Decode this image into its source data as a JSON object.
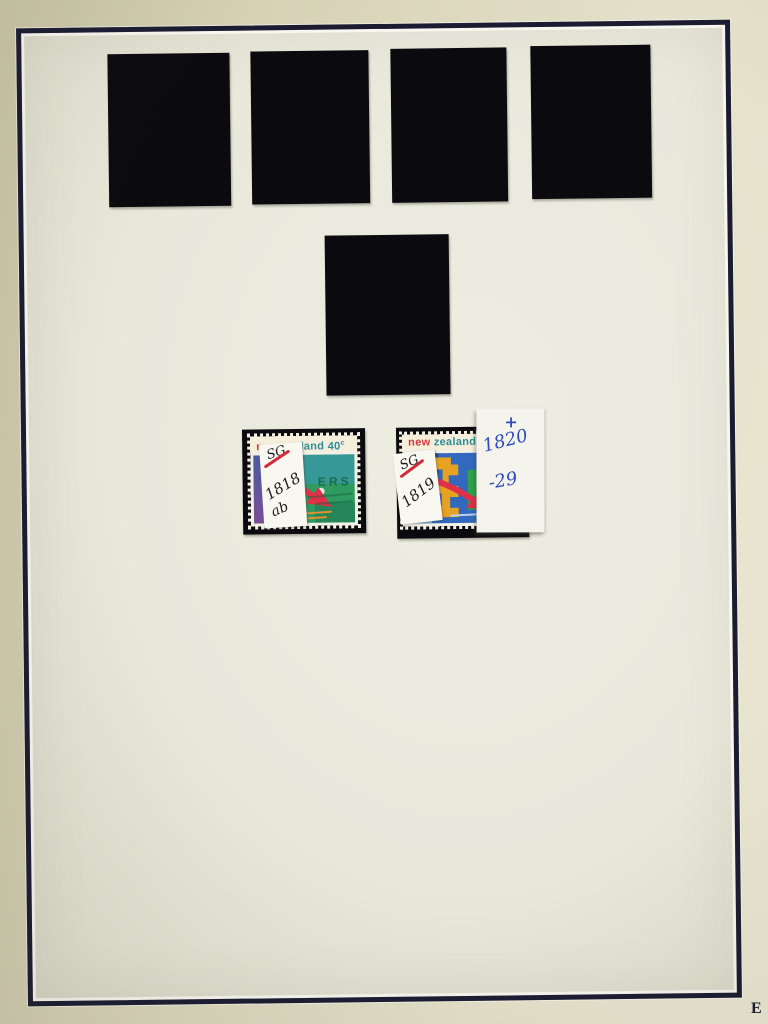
{
  "photo": {
    "corner_mark": "E"
  },
  "colors": {
    "frame_navy": "#1b1b32",
    "paper": "#e9e8db",
    "outer_album": "#d7d2b6",
    "mount_black": "#0b0b0f",
    "stamp_red": "#d4383f",
    "stamp_teal": "#2d8e99",
    "cancel_green": "#12603a",
    "ink_black": "#1d1d1d",
    "ink_blue": "#2f4cc0",
    "slash_red": "#d5293c"
  },
  "mounts": {
    "top_row_count": 4,
    "middle_count": 1
  },
  "stamp_left": {
    "country_word1": "new",
    "country_word2": "zealand",
    "denom_value": "40",
    "denom_unit": "c",
    "cancel_text": "ERS",
    "label": {
      "catalog": "SG",
      "number": "1818",
      "suffix": "ab"
    }
  },
  "stamp_right": {
    "country_word1": "new",
    "country_word2": "zealand",
    "label": {
      "catalog": "SG",
      "number": "1819"
    }
  },
  "note_slip": {
    "line1": "+",
    "line2": "1820",
    "line3": "-29"
  }
}
